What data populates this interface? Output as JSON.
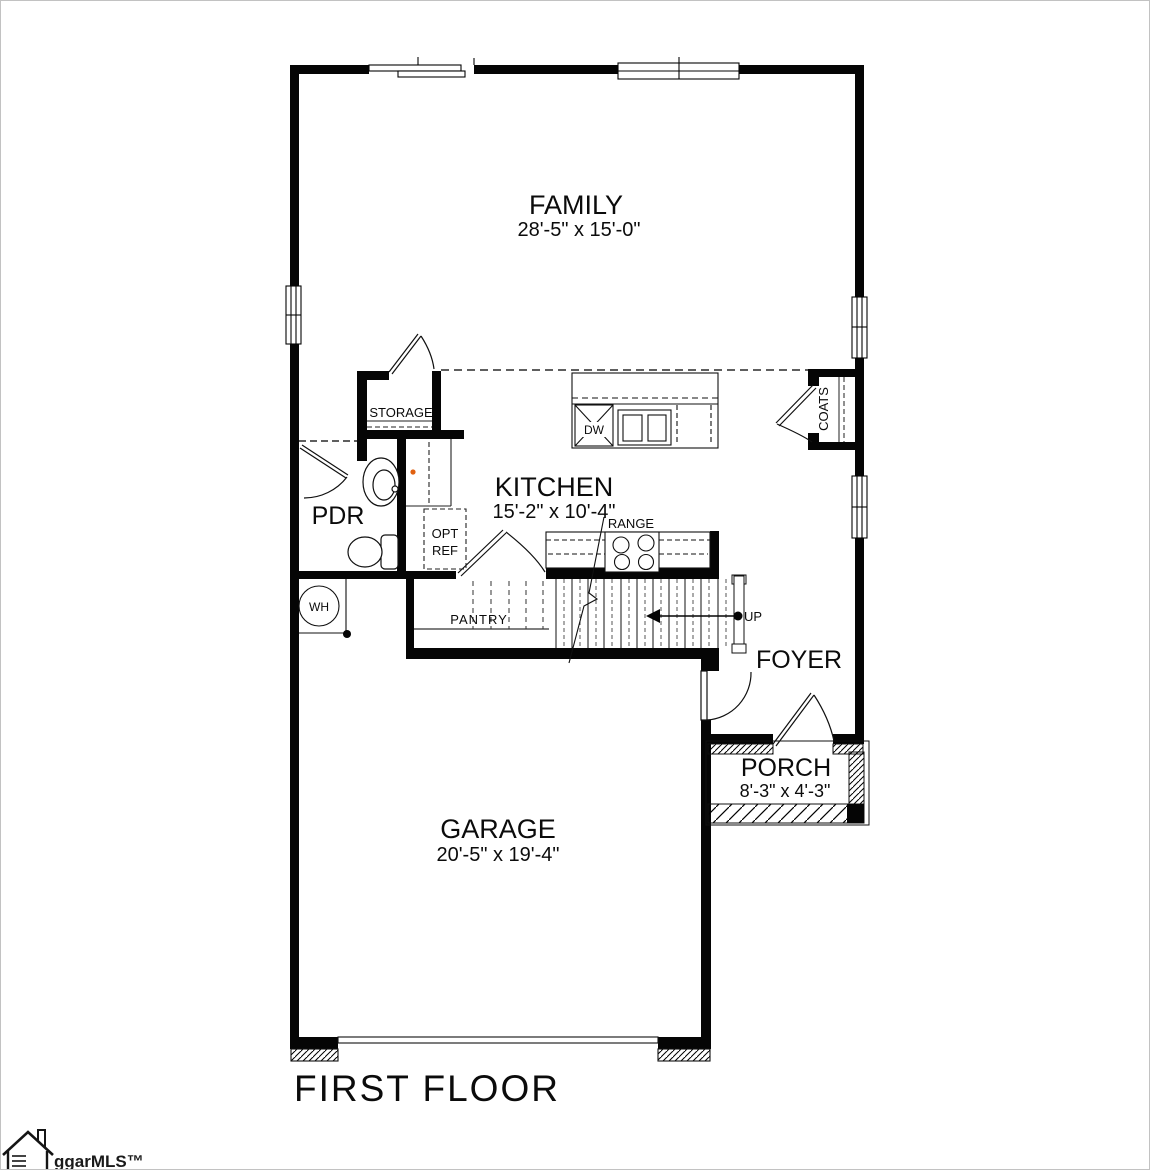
{
  "title": "FIRST FLOOR",
  "watermark": {
    "icon": "house-icon",
    "text": "ggarMLS™"
  },
  "rooms": {
    "family": {
      "label": "FAMILY",
      "dims": "28'-5\" x 15'-0\""
    },
    "kitchen": {
      "label": "KITCHEN",
      "dims": "15'-2\" x 10'-4\""
    },
    "garage": {
      "label": "GARAGE",
      "dims": "20'-5\" x 19'-4\""
    },
    "porch": {
      "label": "PORCH",
      "dims": "8'-3\" x 4'-3\""
    },
    "foyer": {
      "label": "FOYER"
    },
    "pdr": {
      "label": "PDR"
    },
    "storage": {
      "label": "STORAGE"
    },
    "pantry": {
      "label": "PANTRY"
    },
    "coats": {
      "label": "COATS"
    }
  },
  "fixtures": {
    "dishwasher": "DW",
    "range": "RANGE",
    "opt_ref_line1": "OPT",
    "opt_ref_line2": "REF",
    "water_heater": "WH",
    "stairs_direction": "UP"
  },
  "colors": {
    "line": "#000000",
    "accent_dot": "#e06010"
  }
}
